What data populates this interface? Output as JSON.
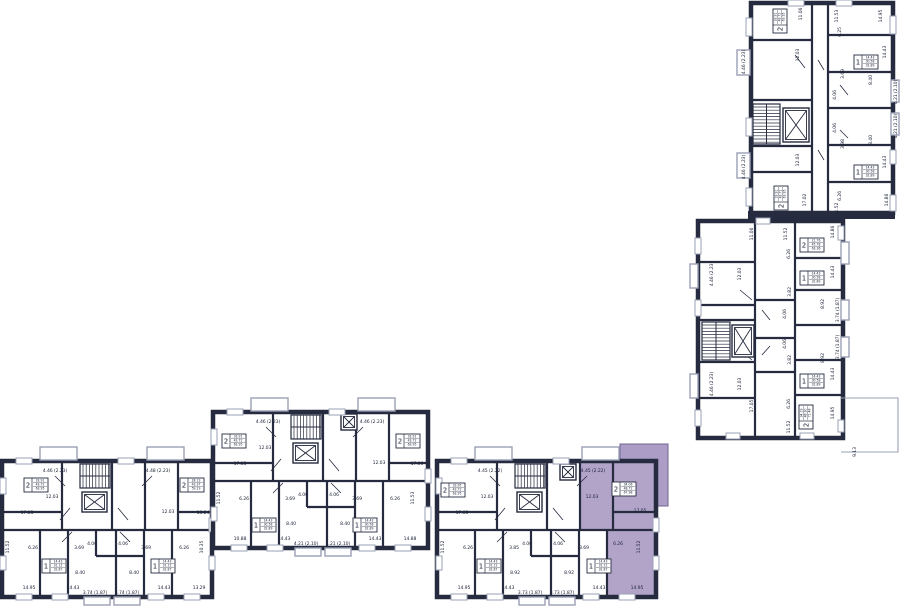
{
  "palette": {
    "wall": "#262b3f",
    "text": "#20263c",
    "background": "#ffffff",
    "highlight": "#b2a4c9",
    "highlight_balcony": "#ab9dc6",
    "highlight_outline": "#6f6390",
    "balcony_line": "#9aa0b5",
    "window_line": "#9aa0b5"
  },
  "selected_apartment": {
    "rooms": "2",
    "areas": [
      "34.06",
      "48.72",
      "67.98"
    ]
  },
  "sections": [
    {
      "id": "top-right",
      "labels": [
        {
          "t": "11.06",
          "x": 802,
          "y": 14,
          "r": -90
        },
        {
          "t": "11.53",
          "x": 838,
          "y": 16,
          "r": -90
        },
        {
          "t": "14.95",
          "x": 882,
          "y": 16,
          "r": -90
        },
        {
          "t": "12.03",
          "x": 799,
          "y": 55,
          "r": -90
        },
        {
          "t": "6.25",
          "x": 841,
          "y": 32,
          "r": -90
        },
        {
          "t": "14.43",
          "x": 886,
          "y": 52,
          "r": -90
        },
        {
          "t": "3.69",
          "x": 844,
          "y": 74,
          "r": -90
        },
        {
          "t": "8.40",
          "x": 872,
          "y": 80,
          "r": -90
        },
        {
          "t": "4.21 (2.10)",
          "x": 897,
          "y": 92,
          "r": -90
        },
        {
          "t": "4.06",
          "x": 836,
          "y": 95,
          "r": -90
        },
        {
          "t": "4.06",
          "x": 836,
          "y": 128,
          "r": -90
        },
        {
          "t": "8.40",
          "x": 872,
          "y": 140,
          "r": -90
        },
        {
          "t": "4.21 (2.10)",
          "x": 897,
          "y": 126,
          "r": -90
        },
        {
          "t": "3.98",
          "x": 844,
          "y": 144,
          "r": -90
        },
        {
          "t": "14.43",
          "x": 886,
          "y": 162,
          "r": -90
        },
        {
          "t": "4.46 (2.23)",
          "x": 745,
          "y": 62,
          "r": -90
        },
        {
          "t": "4.46 (2.23)",
          "x": 745,
          "y": 167,
          "r": -90
        },
        {
          "t": "12.03",
          "x": 799,
          "y": 160,
          "r": -90
        },
        {
          "t": "17.02",
          "x": 806,
          "y": 200,
          "r": -90
        },
        {
          "t": "6.26",
          "x": 841,
          "y": 196,
          "r": -90
        },
        {
          "t": "11.52",
          "x": 838,
          "y": 209,
          "r": -90
        },
        {
          "t": "14.86",
          "x": 888,
          "y": 200,
          "r": -90
        }
      ],
      "apartments": [
        {
          "rooms": "2",
          "areas": [
            "33.91",
            "43.72",
            "63.95"
          ],
          "x": 780,
          "y": 21,
          "r": -90,
          "selected": false
        },
        {
          "rooms": "1",
          "areas": [
            "14.43",
            "30.58",
            "32.89"
          ],
          "x": 866,
          "y": 62,
          "r": 0,
          "selected": false
        },
        {
          "rooms": "1",
          "areas": [
            "14.43",
            "30.58",
            "32.89"
          ],
          "x": 866,
          "y": 172,
          "r": 0,
          "selected": false
        },
        {
          "rooms": "2",
          "areas": [
            "33.91",
            "43.72",
            "63.95"
          ],
          "x": 781,
          "y": 198,
          "r": -90,
          "selected": false
        }
      ]
    },
    {
      "id": "middle-right",
      "labels": [
        {
          "t": "11.06",
          "x": 753,
          "y": 234,
          "r": -90
        },
        {
          "t": "11.52",
          "x": 787,
          "y": 234,
          "r": -90
        },
        {
          "t": "14.86",
          "x": 834,
          "y": 232,
          "r": -90
        },
        {
          "t": "6.26",
          "x": 790,
          "y": 254,
          "r": -90
        },
        {
          "t": "4.46 (2.23)",
          "x": 713,
          "y": 274,
          "r": -90
        },
        {
          "t": "12.03",
          "x": 741,
          "y": 274,
          "r": -90
        },
        {
          "t": "14.43",
          "x": 834,
          "y": 272,
          "r": -90
        },
        {
          "t": "3.82",
          "x": 791,
          "y": 292,
          "r": -90
        },
        {
          "t": "8.92",
          "x": 824,
          "y": 304,
          "r": -90
        },
        {
          "t": "3.74 (1.87)",
          "x": 839,
          "y": 310,
          "r": -90
        },
        {
          "t": "4.06",
          "x": 786,
          "y": 314,
          "r": -90
        },
        {
          "t": "4.06",
          "x": 786,
          "y": 344,
          "r": -90
        },
        {
          "t": "3.74 (1.87)",
          "x": 839,
          "y": 347,
          "r": -90
        },
        {
          "t": "8.92",
          "x": 824,
          "y": 358,
          "r": -90
        },
        {
          "t": "3.82",
          "x": 791,
          "y": 360,
          "r": -90
        },
        {
          "t": "14.43",
          "x": 834,
          "y": 374,
          "r": -90
        },
        {
          "t": "12.03",
          "x": 741,
          "y": 384,
          "r": -90
        },
        {
          "t": "4.46 (2.23)",
          "x": 713,
          "y": 384,
          "r": -90
        },
        {
          "t": "17.05",
          "x": 753,
          "y": 406,
          "r": -90
        },
        {
          "t": "6.26",
          "x": 790,
          "y": 404,
          "r": -90
        },
        {
          "t": "14.95",
          "x": 834,
          "y": 413,
          "r": -90
        },
        {
          "t": "11.52",
          "x": 790,
          "y": 427,
          "r": -90
        },
        {
          "t": "9.13",
          "x": 856,
          "y": 452,
          "r": -90
        }
      ],
      "apartments": [
        {
          "rooms": "2",
          "areas": [
            "21.76",
            "45.78",
            "63.36"
          ],
          "x": 812,
          "y": 245,
          "r": 0,
          "selected": false
        },
        {
          "rooms": "1",
          "areas": [
            "14.43",
            "30.58",
            "32.89"
          ],
          "x": 812,
          "y": 278,
          "r": 0,
          "selected": false
        },
        {
          "rooms": "1",
          "areas": [
            "14.43",
            "30.58",
            "32.89"
          ],
          "x": 812,
          "y": 381,
          "r": 0,
          "selected": false
        },
        {
          "rooms": "2",
          "areas": [
            "34.19",
            "48.30",
            "71.48"
          ],
          "x": 806,
          "y": 417,
          "r": -90,
          "selected": false
        }
      ]
    },
    {
      "id": "bottom-left",
      "labels": [
        {
          "t": "4.46 (2.23)",
          "x": 55,
          "y": 472,
          "r": 0
        },
        {
          "t": "4.48 (2.23)",
          "x": 158,
          "y": 472,
          "r": 0
        },
        {
          "t": "12.03",
          "x": 52,
          "y": 498,
          "r": 0
        },
        {
          "t": "12.03",
          "x": 168,
          "y": 513,
          "r": 0
        },
        {
          "t": "17.05",
          "x": 27,
          "y": 514,
          "r": 0
        },
        {
          "t": "13.24",
          "x": 203,
          "y": 514,
          "r": 0
        },
        {
          "t": "11.52",
          "x": 9,
          "y": 547,
          "r": -90
        },
        {
          "t": "6.26",
          "x": 33,
          "y": 549,
          "r": 0
        },
        {
          "t": "3.69",
          "x": 79,
          "y": 549,
          "r": 0
        },
        {
          "t": "4.06",
          "x": 92,
          "y": 545,
          "r": 0
        },
        {
          "t": "4.06",
          "x": 123,
          "y": 545,
          "r": 0
        },
        {
          "t": "3.69",
          "x": 146,
          "y": 549,
          "r": 0
        },
        {
          "t": "6.26",
          "x": 184,
          "y": 549,
          "r": 0
        },
        {
          "t": "10.35",
          "x": 203,
          "y": 547,
          "r": -90
        },
        {
          "t": "8.40",
          "x": 80,
          "y": 574,
          "r": 0
        },
        {
          "t": "8.40",
          "x": 134,
          "y": 574,
          "r": 0
        },
        {
          "t": "14.95",
          "x": 29,
          "y": 589,
          "r": 0
        },
        {
          "t": "14.43",
          "x": 73,
          "y": 589,
          "r": 0
        },
        {
          "t": "3.74 (1.87)",
          "x": 95,
          "y": 594,
          "r": 0
        },
        {
          "t": "3.74 (1.87)",
          "x": 127,
          "y": 594,
          "r": 0
        },
        {
          "t": "14.43",
          "x": 164,
          "y": 589,
          "r": 0
        },
        {
          "t": "13.29",
          "x": 199,
          "y": 589,
          "r": 0
        }
      ],
      "apartments": [
        {
          "rooms": "2",
          "areas": [
            "33.91",
            "43.72",
            "63.95"
          ],
          "x": 36,
          "y": 485,
          "r": 0,
          "selected": false
        },
        {
          "rooms": "2",
          "areas": [
            "28.13",
            "43.37",
            "59.19"
          ],
          "x": 192,
          "y": 485,
          "r": 0,
          "selected": false
        },
        {
          "rooms": "1",
          "areas": [
            "14.43",
            "31.12",
            "32.87"
          ],
          "x": 54,
          "y": 566,
          "r": 0,
          "selected": false
        },
        {
          "rooms": "1",
          "areas": [
            "14.43",
            "31.12",
            "32.87"
          ],
          "x": 163,
          "y": 566,
          "r": 0,
          "selected": false
        }
      ]
    },
    {
      "id": "bottom-middle",
      "labels": [
        {
          "t": "4.46 (2.23)",
          "x": 268,
          "y": 423,
          "r": 0
        },
        {
          "t": "4.46 (2.23)",
          "x": 372,
          "y": 423,
          "r": 0
        },
        {
          "t": "12.03",
          "x": 265,
          "y": 449,
          "r": 0
        },
        {
          "t": "12.03",
          "x": 379,
          "y": 464,
          "r": 0
        },
        {
          "t": "17.05",
          "x": 240,
          "y": 465,
          "r": 0
        },
        {
          "t": "17.06",
          "x": 417,
          "y": 465,
          "r": 0
        },
        {
          "t": "11.52",
          "x": 220,
          "y": 498,
          "r": -90
        },
        {
          "t": "6.26",
          "x": 244,
          "y": 500,
          "r": 0
        },
        {
          "t": "3.69",
          "x": 290,
          "y": 500,
          "r": 0
        },
        {
          "t": "4.06",
          "x": 303,
          "y": 496,
          "r": 0
        },
        {
          "t": "4.06",
          "x": 334,
          "y": 496,
          "r": 0
        },
        {
          "t": "3.69",
          "x": 357,
          "y": 500,
          "r": 0
        },
        {
          "t": "6.26",
          "x": 395,
          "y": 500,
          "r": 0
        },
        {
          "t": "11.53",
          "x": 414,
          "y": 498,
          "r": -90
        },
        {
          "t": "8.40",
          "x": 291,
          "y": 525,
          "r": 0
        },
        {
          "t": "8.40",
          "x": 345,
          "y": 525,
          "r": 0
        },
        {
          "t": "10.88",
          "x": 240,
          "y": 540,
          "r": 0
        },
        {
          "t": "14.43",
          "x": 284,
          "y": 540,
          "r": 0
        },
        {
          "t": "4.21 (2.10)",
          "x": 306,
          "y": 545,
          "r": 0
        },
        {
          "t": "4.21 (2.10)",
          "x": 338,
          "y": 545,
          "r": 0
        },
        {
          "t": "14.43",
          "x": 375,
          "y": 540,
          "r": 0
        },
        {
          "t": "14.88",
          "x": 410,
          "y": 540,
          "r": 0
        }
      ],
      "apartments": [
        {
          "rooms": "2",
          "areas": [
            "33.91",
            "43.72",
            "63.95"
          ],
          "x": 234,
          "y": 441,
          "r": 0,
          "selected": false
        },
        {
          "rooms": "2",
          "areas": [
            "33.91",
            "43.72",
            "63.95"
          ],
          "x": 408,
          "y": 441,
          "r": 0,
          "selected": false
        },
        {
          "rooms": "1",
          "areas": [
            "14.43",
            "30.58",
            "32.89"
          ],
          "x": 264,
          "y": 525,
          "r": 0,
          "selected": false
        },
        {
          "rooms": "1",
          "areas": [
            "14.43",
            "30.58",
            "32.89"
          ],
          "x": 365,
          "y": 525,
          "r": 0,
          "selected": false
        }
      ]
    },
    {
      "id": "bottom-right",
      "labels": [
        {
          "t": "4.45 (2.22)",
          "x": 490,
          "y": 472,
          "r": 0
        },
        {
          "t": "4.45 (2.22)",
          "x": 593,
          "y": 472,
          "r": 0
        },
        {
          "t": "12.03",
          "x": 487,
          "y": 498,
          "r": 0
        },
        {
          "t": "12.03",
          "x": 592,
          "y": 498,
          "r": 0
        },
        {
          "t": "17.05",
          "x": 462,
          "y": 514,
          "r": 0
        },
        {
          "t": "17.05",
          "x": 640,
          "y": 512,
          "r": 0
        },
        {
          "t": "11.52",
          "x": 444,
          "y": 547,
          "r": -90
        },
        {
          "t": "6.26",
          "x": 468,
          "y": 549,
          "r": 0
        },
        {
          "t": "3.85",
          "x": 514,
          "y": 549,
          "r": 0
        },
        {
          "t": "4.06",
          "x": 527,
          "y": 545,
          "r": 0
        },
        {
          "t": "4.06",
          "x": 558,
          "y": 545,
          "r": 0
        },
        {
          "t": "3.69",
          "x": 584,
          "y": 549,
          "r": 0
        },
        {
          "t": "6.26",
          "x": 618,
          "y": 545,
          "r": 0
        },
        {
          "t": "11.52",
          "x": 640,
          "y": 547,
          "r": -90
        },
        {
          "t": "8.92",
          "x": 515,
          "y": 574,
          "r": 0
        },
        {
          "t": "8.92",
          "x": 569,
          "y": 574,
          "r": 0
        },
        {
          "t": "14.95",
          "x": 464,
          "y": 589,
          "r": 0
        },
        {
          "t": "14.43",
          "x": 508,
          "y": 589,
          "r": 0
        },
        {
          "t": "3.73 (1.87)",
          "x": 530,
          "y": 594,
          "r": 0
        },
        {
          "t": "3.73 (1.87)",
          "x": 562,
          "y": 594,
          "r": 0
        },
        {
          "t": "14.43",
          "x": 599,
          "y": 589,
          "r": 0
        },
        {
          "t": "14.95",
          "x": 637,
          "y": 589,
          "r": 0
        }
      ],
      "apartments": [
        {
          "rooms": "2",
          "areas": [
            "33.95",
            "43.72",
            "63.95"
          ],
          "x": 453,
          "y": 490,
          "r": 0,
          "selected": false
        },
        {
          "rooms": "2",
          "areas": [
            "34.06",
            "48.72",
            "67.98"
          ],
          "x": 624,
          "y": 489,
          "r": 0,
          "selected": true
        },
        {
          "rooms": "1",
          "areas": [
            "14.43",
            "31.12",
            "32.87"
          ],
          "x": 489,
          "y": 566,
          "r": 0,
          "selected": false
        },
        {
          "rooms": "1",
          "areas": [
            "14.43",
            "31.12",
            "32.87"
          ],
          "x": 599,
          "y": 566,
          "r": 0,
          "selected": false
        }
      ]
    }
  ]
}
